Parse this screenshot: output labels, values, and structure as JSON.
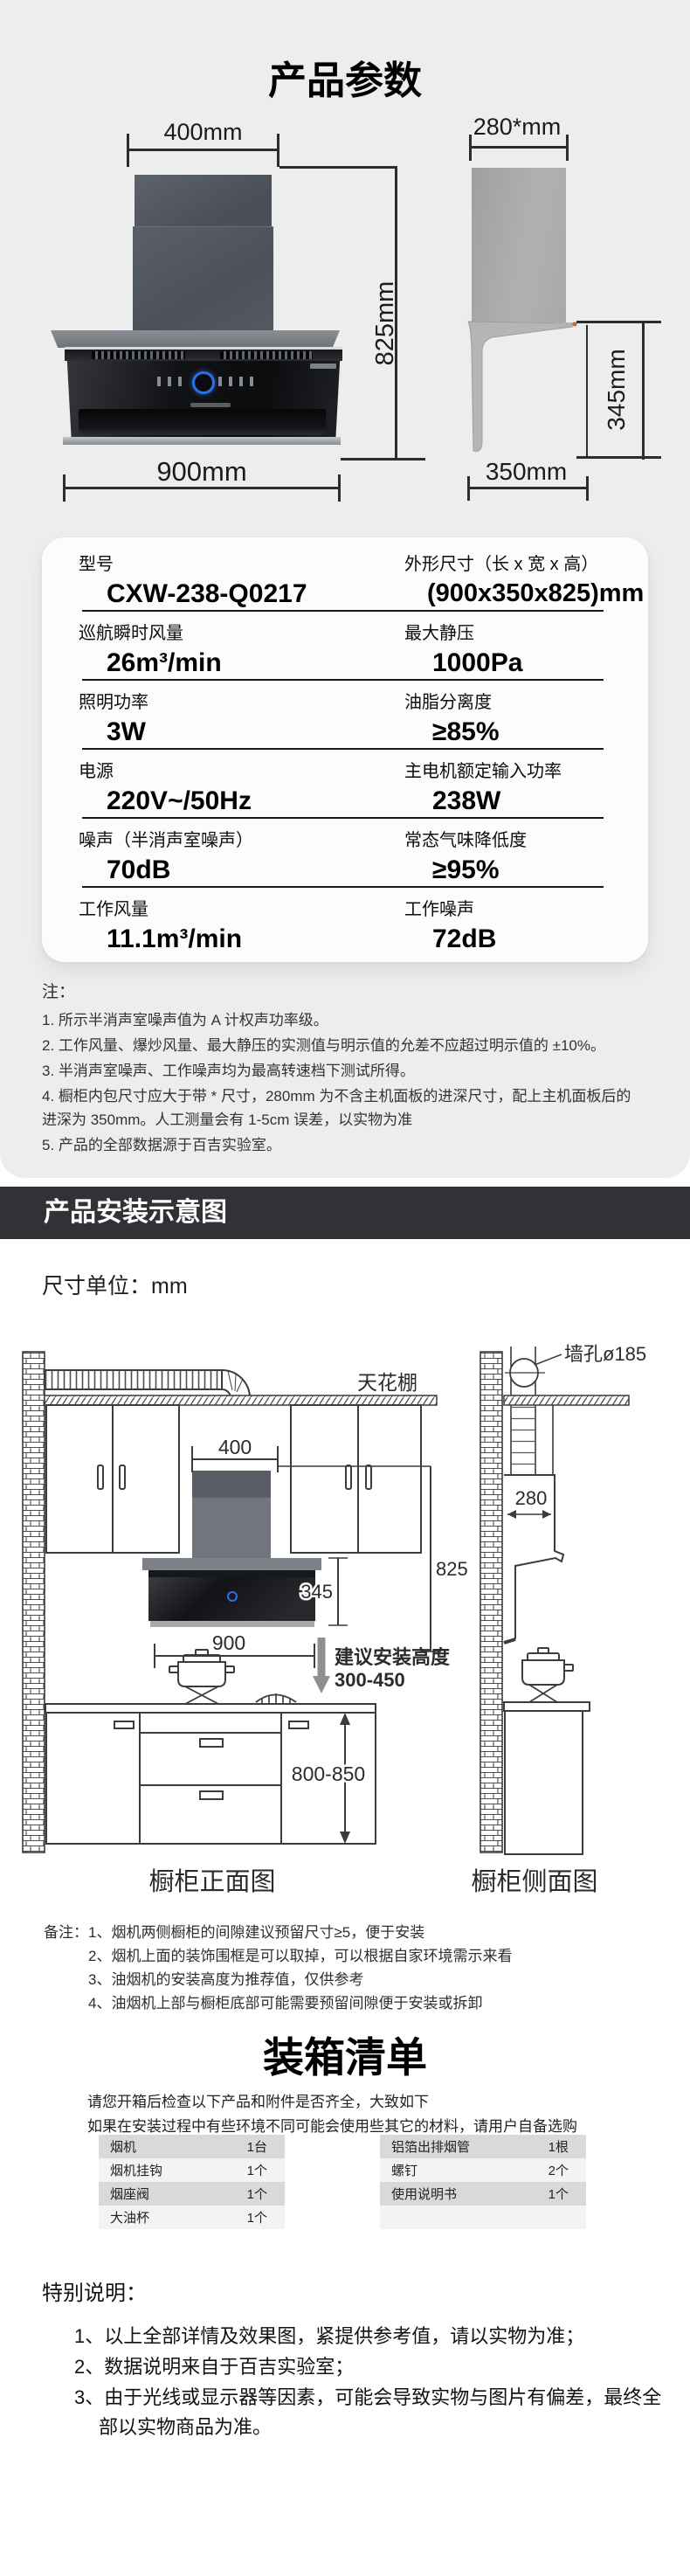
{
  "colors": {
    "top_bg": "#ededee",
    "band_bg": "#323236",
    "accent_blue": "#2f6fe4",
    "table_row_dark": "#d9d9d9",
    "table_row_light": "#f3f3f3"
  },
  "section_params": {
    "title": "产品参数",
    "front_view": {
      "dim_width_top": "400mm",
      "dim_height": "825mm",
      "dim_width_bottom": "900mm"
    },
    "side_view": {
      "dim_depth_top": "280*mm",
      "dim_height": "345mm",
      "dim_depth_bottom": "350mm"
    }
  },
  "spec_table": {
    "rows": [
      {
        "left_label": "型号",
        "left_value": "CXW-238-Q0217",
        "right_label": "外形尺寸（长 x 宽 x 高）",
        "right_value": "(900x350x825)mm"
      },
      {
        "left_label": "巡航瞬时风量",
        "left_value": "26m³/min",
        "right_label": "最大静压",
        "right_value": "1000Pa"
      },
      {
        "left_label": "照明功率",
        "left_value": "3W",
        "right_label": "油脂分离度",
        "right_value": "≥85%"
      },
      {
        "left_label": "电源",
        "left_value": "220V~/50Hz",
        "right_label": "主电机额定输入功率",
        "right_value": "238W"
      },
      {
        "left_label": "噪声（半消声室噪声）",
        "left_value": "70dB",
        "right_label": "常态气味降低度",
        "right_value": "≥95%"
      },
      {
        "left_label": "工作风量",
        "left_value": "11.1m³/min",
        "right_label": "工作噪声",
        "right_value": "72dB"
      }
    ]
  },
  "notes": {
    "heading": "注：",
    "items": [
      "1. 所示半消声室噪声值为 A 计权声功率级。",
      "2. 工作风量、爆炒风量、最大静压的实测值与明示值的允差不应超过明示值的 ±10%。",
      "3. 半消声室噪声、工作噪声均为最高转速档下测试所得。",
      "4. 橱柜内包尺寸应大于带 * 尺寸，280mm 为不含主机面板的进深尺寸，配上主机面板后的进深为 350mm。人工测量会有 1-5cm 误差，以实物为准",
      "5. 产品的全部数据源于百吉实验室。"
    ]
  },
  "install_section": {
    "header": "产品安装示意图",
    "unit_label": "尺寸单位：mm",
    "front_diagram": {
      "ceiling_label": "天花棚",
      "dim_400": "400",
      "dim_825": "825",
      "dim_345": "345",
      "dim_900": "900",
      "install_height_line1": "建议安装高度",
      "install_height_line2": "300-450",
      "dim_800_850": "800-850",
      "caption": "橱柜正面图"
    },
    "side_diagram": {
      "wall_hole_label": "墙孔ø185",
      "dim_280": "280",
      "caption": "橱柜侧面图"
    },
    "remarks_label": "备注：",
    "remarks": [
      "1、烟机两侧橱柜的间隙建议预留尺寸≥5，便于安装",
      "2、烟机上面的装饰围框是可以取掉，可以根据自家环境需示来看",
      "3、油烟机的安装高度为推荐值，仅供参考",
      "4、油烟机上部与橱柜底部可能需要预留间隙便于安装或拆卸"
    ]
  },
  "packing_section": {
    "title": "装箱清单",
    "intro": [
      "请您开箱后检查以下产品和附件是否齐全，大致如下",
      "如果在安装过程中有些环境不同可能会使用些其它的材料，请用户自备选购"
    ],
    "left_table": [
      {
        "name": "烟机",
        "qty": "1台"
      },
      {
        "name": "烟机挂钩",
        "qty": "1个"
      },
      {
        "name": "烟座阀",
        "qty": "1个"
      },
      {
        "name": "大油杯",
        "qty": "1个"
      }
    ],
    "right_table": [
      {
        "name": "铝箔出排烟管",
        "qty": "1根"
      },
      {
        "name": "螺钉",
        "qty": "2个"
      },
      {
        "name": "使用说明书",
        "qty": "1个"
      },
      {
        "name": "",
        "qty": ""
      }
    ]
  },
  "special_section": {
    "heading": "特别说明：",
    "items": [
      "1、以上全部详情及效果图，紧提供参考值，请以实物为准；",
      "2、数据说明来自于百吉实验室；",
      "3、由于光线或显示器等因素，可能会导致实物与图片有偏差，最终全部以实物商品为准。"
    ]
  }
}
